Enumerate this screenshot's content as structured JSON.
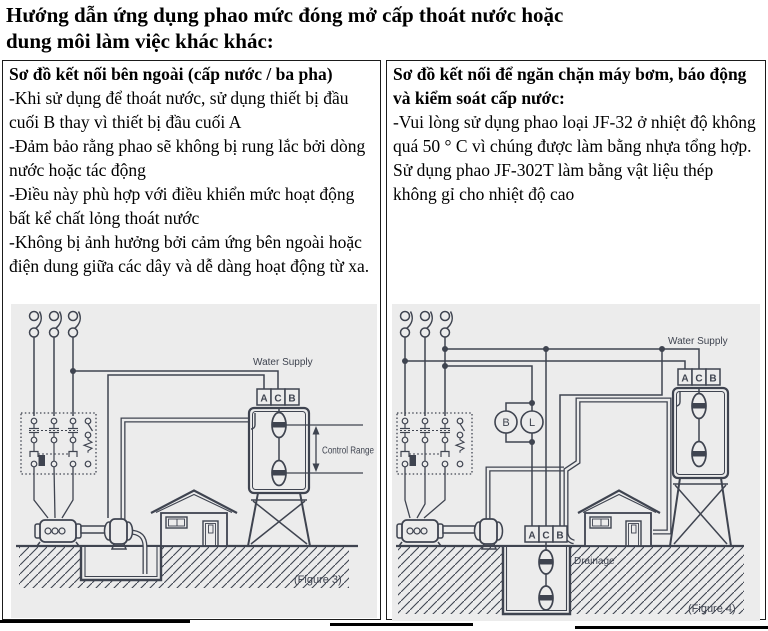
{
  "page": {
    "title_line1": "Hướng dẫn ứng dụng phao mức đóng mở cấp thoát nước hoặc",
    "title_line2": "dung môi làm việc khác khác:"
  },
  "left_panel": {
    "heading": "Sơ đồ kết nối bên ngoài (cấp nước / ba pha)",
    "paragraphs": [
      "-Khi sử dụng để thoát nước, sử dụng thiết bị đầu cuối B thay vì thiết bị đầu cuối A",
      "-Đảm bảo rằng phao sẽ không bị rung lắc bởi dòng nước hoặc tác động",
      "-Điều này phù hợp với điều khiển mức hoạt động bất kể chất lỏng thoát nước",
      "-Không bị ảnh hưởng bởi cảm ứng bên ngoài hoặc điện dung giữa các dây và dễ dàng hoạt động từ xa."
    ],
    "figure": {
      "water_supply": "Water Supply",
      "terminals": {
        "a": "A",
        "c": "C",
        "b": "B"
      },
      "control_range": "Control Range",
      "caption": "(Figure 3)"
    }
  },
  "right_panel": {
    "heading": "Sơ đồ kết nối để ngăn chặn máy bơm, báo động và kiểm soát cấp nước:",
    "paragraphs": [
      "-Vui lòng sử dụng phao loại JF-32 ở nhiệt độ không quá 50 ° C vì chúng được làm bằng nhựa tổng hợp. Sử dụng phao JF-302T làm bằng vật liệu thép không gỉ cho nhiệt độ cao"
    ],
    "figure": {
      "water_supply": "Water Supply",
      "tank_terminals": {
        "a": "A",
        "c": "C",
        "b": "B"
      },
      "sump_terminals": {
        "a": "A",
        "c": "C",
        "b": "B"
      },
      "buzzer": "B",
      "lamp": "L",
      "drainage": "Drainage",
      "caption": "(Figure 4)"
    }
  },
  "colors": {
    "diagram_line": "#3f4450",
    "diagram_background": "#ececec",
    "text": "#000000",
    "border": "#1b1b1b"
  }
}
